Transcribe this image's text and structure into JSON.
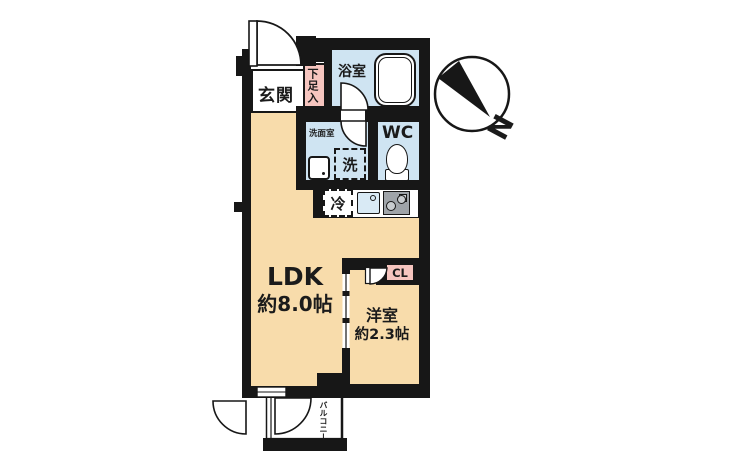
{
  "floorplan": {
    "labels": {
      "entrance": "玄関",
      "shoe_storage": "下足入",
      "bathroom": "浴室",
      "washroom": "洗面室",
      "washer": "洗",
      "toilet_room": "WC",
      "fridge": "冷",
      "ldk_name": "LDK",
      "ldk_size": "約8.0帖",
      "western_room_name": "洋室",
      "western_room_size": "約2.3帖",
      "closet": "CL",
      "balcony": "バルコニー"
    },
    "compass": {
      "north_label": "N"
    },
    "colors": {
      "floor": "#f8dcab",
      "wet_area": "#cfe4f2",
      "accent_pink": "#f6c5bf",
      "wall": "#171717",
      "counter": "#ffffff",
      "stove_gray": "#9fa4a9"
    }
  }
}
